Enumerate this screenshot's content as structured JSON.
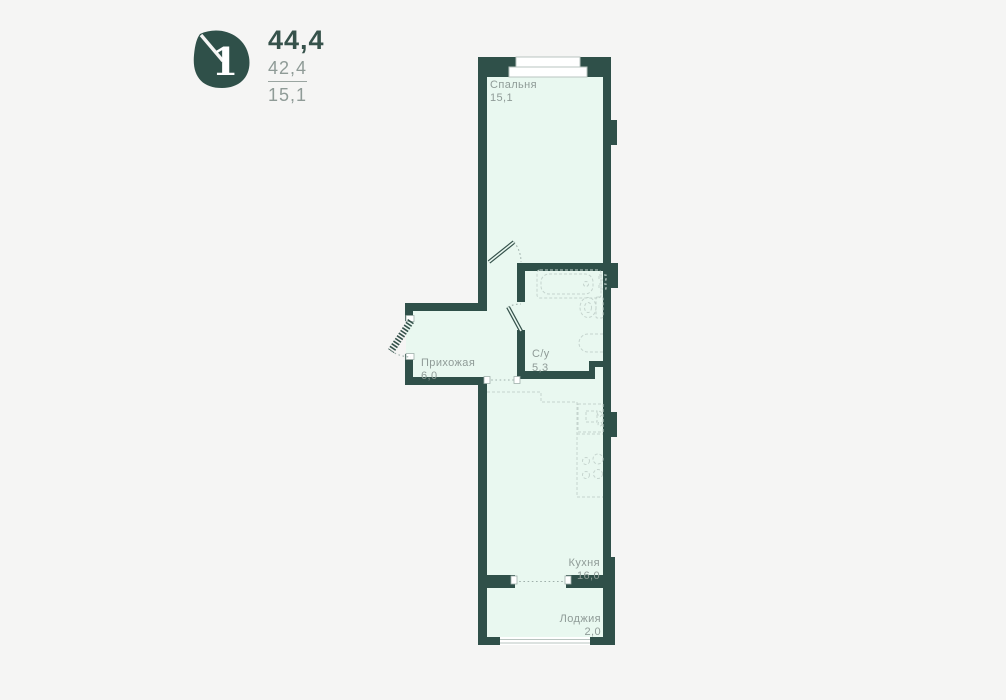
{
  "page": {
    "background": "#f5f5f4"
  },
  "legend": {
    "rooms_count": "1",
    "total_area": "44,4",
    "living_area": "42,4",
    "room_area": "15,1"
  },
  "colors": {
    "wall": "#2f5049",
    "room_fill": "#e9f8f0",
    "label": "#8f9b97",
    "fixture": "#c5d4ce",
    "badge": "#2f5049"
  },
  "plan": {
    "rooms": [
      {
        "name": "Спальня",
        "area": "15,1"
      },
      {
        "name": "Прихожая",
        "area": "6,0"
      },
      {
        "name": "С/у",
        "area": "5,3"
      },
      {
        "name": "Кухня",
        "area": "16,0"
      },
      {
        "name": "Лоджия",
        "area": "2,0"
      }
    ]
  }
}
